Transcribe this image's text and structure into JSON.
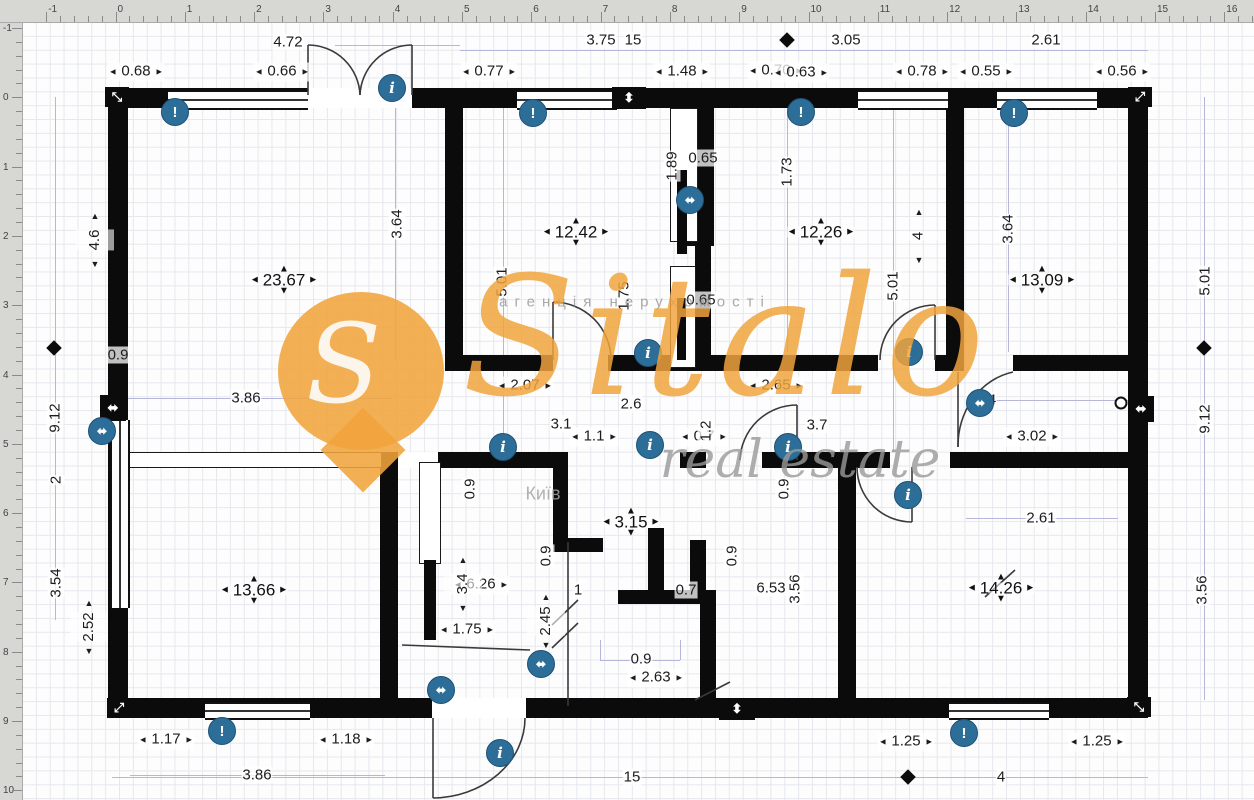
{
  "colors": {
    "wall": "#0b0b0b",
    "dim_text": "#1c1c1c",
    "helper_line": "#b6b6db",
    "grid": "#e6e8ee",
    "ruler_bg": "#d7d7d3",
    "icon_blue": "#2d6e99",
    "watermark_orange": "#f1a43c"
  },
  "watermark": {
    "brand": "Sitalo",
    "agency_line": "агенція нерухомості",
    "real_estate": "real estate",
    "city": "Київ",
    "pin_letter": "S"
  },
  "rulers": {
    "top": {
      "labels": [
        "-1",
        "0",
        "1",
        "2",
        "3",
        "4",
        "5",
        "6",
        "7",
        "8",
        "9",
        "10",
        "11",
        "12",
        "13",
        "14",
        "15",
        "16"
      ],
      "start_px": 46.2,
      "step_px": 69.3,
      "minor_px": 13.86
    },
    "left": {
      "labels": [
        "-1",
        "0",
        "1",
        "2",
        "3",
        "4",
        "5",
        "6",
        "7",
        "8",
        "9",
        "10"
      ],
      "start_px": 28,
      "step_px": 69.3,
      "minor_px": 13.86
    }
  },
  "rooms": [
    {
      "label": "23.67",
      "x": 284,
      "y": 280
    },
    {
      "label": "12.42",
      "x": 576,
      "y": 232
    },
    {
      "label": "12.26",
      "x": 821,
      "y": 232
    },
    {
      "label": "13.09",
      "x": 1042,
      "y": 280
    },
    {
      "label": "13.66",
      "x": 254,
      "y": 590
    },
    {
      "label": "3.15",
      "x": 631,
      "y": 522
    },
    {
      "label": "14.26",
      "x": 1001,
      "y": 588
    }
  ],
  "dims_h_arrows": [
    {
      "text": "0.68",
      "x": 136,
      "y": 72
    },
    {
      "text": "0.66",
      "x": 282,
      "y": 72
    },
    {
      "text": "0.77",
      "x": 489,
      "y": 72
    },
    {
      "text": "1.48",
      "x": 682,
      "y": 72
    },
    {
      "text": "0.70",
      "x": 776,
      "y": 71
    },
    {
      "text": "0.63",
      "x": 801,
      "y": 73
    },
    {
      "text": "0.78",
      "x": 922,
      "y": 72
    },
    {
      "text": "0.55",
      "x": 986,
      "y": 72
    },
    {
      "text": "0.56",
      "x": 1122,
      "y": 72
    },
    {
      "text": "2.07",
      "x": 525,
      "y": 386
    },
    {
      "text": "2.65",
      "x": 776,
      "y": 386
    },
    {
      "text": "1.1",
      "x": 594,
      "y": 437
    },
    {
      "text": "0.7",
      "x": 704,
      "y": 437
    },
    {
      "text": "3.02",
      "x": 1032,
      "y": 437
    },
    {
      "text": "6.26",
      "x": 481,
      "y": 585
    },
    {
      "text": "1.75",
      "x": 467,
      "y": 630
    },
    {
      "text": "2.63",
      "x": 656,
      "y": 678
    },
    {
      "text": "1.17",
      "x": 166,
      "y": 740
    },
    {
      "text": "1.18",
      "x": 346,
      "y": 740
    },
    {
      "text": "1.25",
      "x": 906,
      "y": 742
    },
    {
      "text": "1.25",
      "x": 1097,
      "y": 742
    }
  ],
  "dims_h_plain": [
    {
      "text": "4.72",
      "x": 288,
      "y": 42
    },
    {
      "text": "3.75",
      "x": 601,
      "y": 40
    },
    {
      "text": "15",
      "x": 633,
      "y": 40
    },
    {
      "text": "3.05",
      "x": 846,
      "y": 40
    },
    {
      "text": "2.61",
      "x": 1046,
      "y": 40
    },
    {
      "text": "0.9",
      "x": 118,
      "y": 355
    },
    {
      "text": "3.86",
      "x": 246,
      "y": 398
    },
    {
      "text": "2.6",
      "x": 631,
      "y": 404
    },
    {
      "text": "3.1",
      "x": 561,
      "y": 424
    },
    {
      "text": "3.7",
      "x": 817,
      "y": 425
    },
    {
      "text": "4",
      "x": 992,
      "y": 400
    },
    {
      "text": "0.65",
      "x": 703,
      "y": 158
    },
    {
      "text": "0.65",
      "x": 701,
      "y": 300
    },
    {
      "text": "2.61",
      "x": 1041,
      "y": 518
    },
    {
      "text": "1",
      "x": 578,
      "y": 590
    },
    {
      "text": "0.9",
      "x": 641,
      "y": 659
    },
    {
      "text": "6.53",
      "x": 771,
      "y": 588
    },
    {
      "text": "0.7",
      "x": 686,
      "y": 590
    },
    {
      "text": "3.86",
      "x": 257,
      "y": 775
    },
    {
      "text": "15",
      "x": 632,
      "y": 777
    },
    {
      "text": "4",
      "x": 1001,
      "y": 777
    }
  ],
  "dims_v_plain": [
    {
      "text": "9.12",
      "x": 55,
      "y": 418
    },
    {
      "text": "2",
      "x": 56,
      "y": 480
    },
    {
      "text": "3.54",
      "x": 56,
      "y": 583
    },
    {
      "text": "3.64",
      "x": 397,
      "y": 224
    },
    {
      "text": "5.01",
      "x": 502,
      "y": 282
    },
    {
      "text": "1.89",
      "x": 672,
      "y": 166
    },
    {
      "text": "1.73",
      "x": 787,
      "y": 172
    },
    {
      "text": "1.75",
      "x": 624,
      "y": 296
    },
    {
      "text": "1.2",
      "x": 706,
      "y": 431
    },
    {
      "text": "5.01",
      "x": 893,
      "y": 286
    },
    {
      "text": "3.64",
      "x": 1008,
      "y": 229
    },
    {
      "text": "5.01",
      "x": 1205,
      "y": 281
    },
    {
      "text": "9.12",
      "x": 1205,
      "y": 419
    },
    {
      "text": "0.9",
      "x": 470,
      "y": 489
    },
    {
      "text": "0.9",
      "x": 784,
      "y": 489
    },
    {
      "text": "0.9",
      "x": 546,
      "y": 556
    },
    {
      "text": "0.9",
      "x": 732,
      "y": 556
    },
    {
      "text": "3.56",
      "x": 795,
      "y": 589
    },
    {
      "text": "3.56",
      "x": 1202,
      "y": 590
    }
  ],
  "dims_v_arrows": [
    {
      "text": "4.6",
      "x": 95,
      "y": 240
    },
    {
      "text": "2.52",
      "x": 89,
      "y": 627
    },
    {
      "text": "4",
      "x": 919,
      "y": 236
    },
    {
      "text": "3.4",
      "x": 463,
      "y": 584
    },
    {
      "text": "2.45",
      "x": 546,
      "y": 621
    }
  ],
  "diamonds": [
    {
      "x": 787,
      "y": 40
    },
    {
      "x": 54,
      "y": 348
    },
    {
      "x": 1204,
      "y": 348
    },
    {
      "x": 908,
      "y": 777
    }
  ],
  "icons": {
    "warning": [
      {
        "x": 175,
        "y": 112
      },
      {
        "x": 533,
        "y": 113
      },
      {
        "x": 801,
        "y": 112
      },
      {
        "x": 1014,
        "y": 113
      },
      {
        "x": 222,
        "y": 731
      },
      {
        "x": 964,
        "y": 733
      }
    ],
    "info": [
      {
        "x": 392,
        "y": 88
      },
      {
        "x": 648,
        "y": 353
      },
      {
        "x": 909,
        "y": 352
      },
      {
        "x": 503,
        "y": 447
      },
      {
        "x": 650,
        "y": 445
      },
      {
        "x": 788,
        "y": 447
      },
      {
        "x": 908,
        "y": 495
      },
      {
        "x": 500,
        "y": 753
      }
    ],
    "measure": [
      {
        "x": 102,
        "y": 431
      },
      {
        "x": 690,
        "y": 200
      },
      {
        "x": 980,
        "y": 403
      },
      {
        "x": 441,
        "y": 690
      },
      {
        "x": 541,
        "y": 664
      }
    ],
    "glyph_warning": "!",
    "glyph_info": "i",
    "glyph_measure": "⬌"
  },
  "wall_blocks": [
    {
      "x": 629,
      "y": 98,
      "w": 34,
      "h": 22,
      "glyph": "⬍"
    },
    {
      "x": 737,
      "y": 709,
      "w": 36,
      "h": 22,
      "glyph": "⬍"
    },
    {
      "x": 113,
      "y": 408,
      "w": 26,
      "h": 26,
      "glyph": "⬌"
    },
    {
      "x": 1141,
      "y": 409,
      "w": 26,
      "h": 26,
      "glyph": "⬌"
    },
    {
      "x": 117,
      "y": 97,
      "w": 24,
      "h": 20,
      "glyph": "⤡"
    },
    {
      "x": 1140,
      "y": 97,
      "w": 24,
      "h": 20,
      "glyph": "⤢"
    },
    {
      "x": 119,
      "y": 708,
      "w": 24,
      "h": 20,
      "glyph": "⤢"
    },
    {
      "x": 1139,
      "y": 707,
      "w": 24,
      "h": 20,
      "glyph": "⤡"
    }
  ],
  "pivots": [
    {
      "x": 1121,
      "y": 403
    }
  ],
  "geometry": {
    "walls": [
      [
        108,
        88,
        1040,
        20
      ],
      [
        108,
        698,
        1040,
        20
      ],
      [
        108,
        88,
        20,
        630
      ],
      [
        1128,
        88,
        20,
        630
      ],
      [
        445,
        108,
        18,
        252
      ],
      [
        445,
        355,
        108,
        16
      ],
      [
        608,
        355,
        270,
        16
      ],
      [
        935,
        355,
        29,
        16
      ],
      [
        946,
        88,
        18,
        268
      ],
      [
        1013,
        355,
        115,
        16
      ],
      [
        698,
        108,
        16,
        130
      ],
      [
        677,
        230,
        37,
        16
      ],
      [
        695,
        244,
        16,
        122
      ],
      [
        380,
        452,
        18,
        246
      ],
      [
        438,
        452,
        116,
        16
      ],
      [
        553,
        452,
        15,
        88
      ],
      [
        553,
        538,
        50,
        14
      ],
      [
        648,
        528,
        16,
        62
      ],
      [
        690,
        540,
        16,
        52
      ],
      [
        618,
        590,
        88,
        14
      ],
      [
        700,
        590,
        16,
        108
      ],
      [
        680,
        452,
        26,
        16
      ],
      [
        762,
        452,
        128,
        16
      ],
      [
        950,
        452,
        178,
        16
      ],
      [
        838,
        467,
        18,
        231
      ]
    ],
    "gaps": [
      [
        308,
        88,
        104,
        20
      ],
      [
        432,
        698,
        94,
        20
      ],
      [
        398,
        452,
        40,
        16
      ]
    ],
    "windows_h": [
      [
        168,
        90,
        140,
        16
      ],
      [
        517,
        90,
        100,
        16
      ],
      [
        858,
        90,
        90,
        16
      ],
      [
        997,
        90,
        100,
        16
      ],
      [
        205,
        702,
        105,
        14
      ],
      [
        949,
        702,
        100,
        14
      ]
    ],
    "windows_v": [
      [
        110,
        420,
        16,
        188
      ]
    ],
    "partitions_h": [
      [
        112,
        452,
        268,
        14
      ]
    ],
    "partitions_v": [
      [
        419,
        462,
        20,
        100
      ],
      [
        670,
        108,
        26,
        132
      ],
      [
        670,
        266,
        24,
        100
      ]
    ],
    "bars": [
      [
        677,
        170,
        10,
        84
      ],
      [
        677,
        298,
        9,
        62
      ],
      [
        424,
        560,
        12,
        80
      ]
    ],
    "plines_h": [
      [
        335,
        45,
        125
      ],
      [
        460,
        50,
        688
      ],
      [
        125,
        398,
        267
      ],
      [
        980,
        400,
        148
      ],
      [
        966,
        518,
        152
      ],
      [
        130,
        775,
        255
      ],
      [
        112,
        777,
        1036
      ],
      [
        600,
        660,
        80
      ]
    ],
    "plines_v": [
      [
        55,
        97,
        523
      ],
      [
        395,
        108,
        252
      ],
      [
        503,
        108,
        344
      ],
      [
        893,
        108,
        344
      ],
      [
        1008,
        108,
        244
      ],
      [
        673,
        108,
        122
      ],
      [
        787,
        108,
        244
      ],
      [
        1204,
        97,
        603
      ],
      [
        600,
        640,
        20
      ],
      [
        680,
        640,
        20
      ]
    ],
    "arc_paths": [
      "M308,45 L308,95",
      "M308,45 A52,52 0 0 1 360,95",
      "M412,45 L412,95",
      "M412,45 A52,52 0 0 0 360,95",
      "M553,302 L553,360",
      "M553,302 A58,58 0 0 1 611,360",
      "M935,305 L935,360",
      "M935,305 A55,55 0 0 0 880,360",
      "M797,405 L797,460",
      "M797,405 A57,57 0 0 0 740,460",
      "M958,372 L958,447",
      "M958,447 A68,75 0 0 1 1013,372",
      "M912,467 L912,522",
      "M912,522 A55,55 0 0 1 857,467",
      "M433,718 L433,798",
      "M525,718 A93,80 0 0 1 433,798",
      "M568,542 L568,706",
      "M402,645 L530,650",
      "M552,625 L578,600",
      "M552,648 L578,623",
      "M695,700 L730,682",
      "M985,597 L1015,570"
    ]
  }
}
